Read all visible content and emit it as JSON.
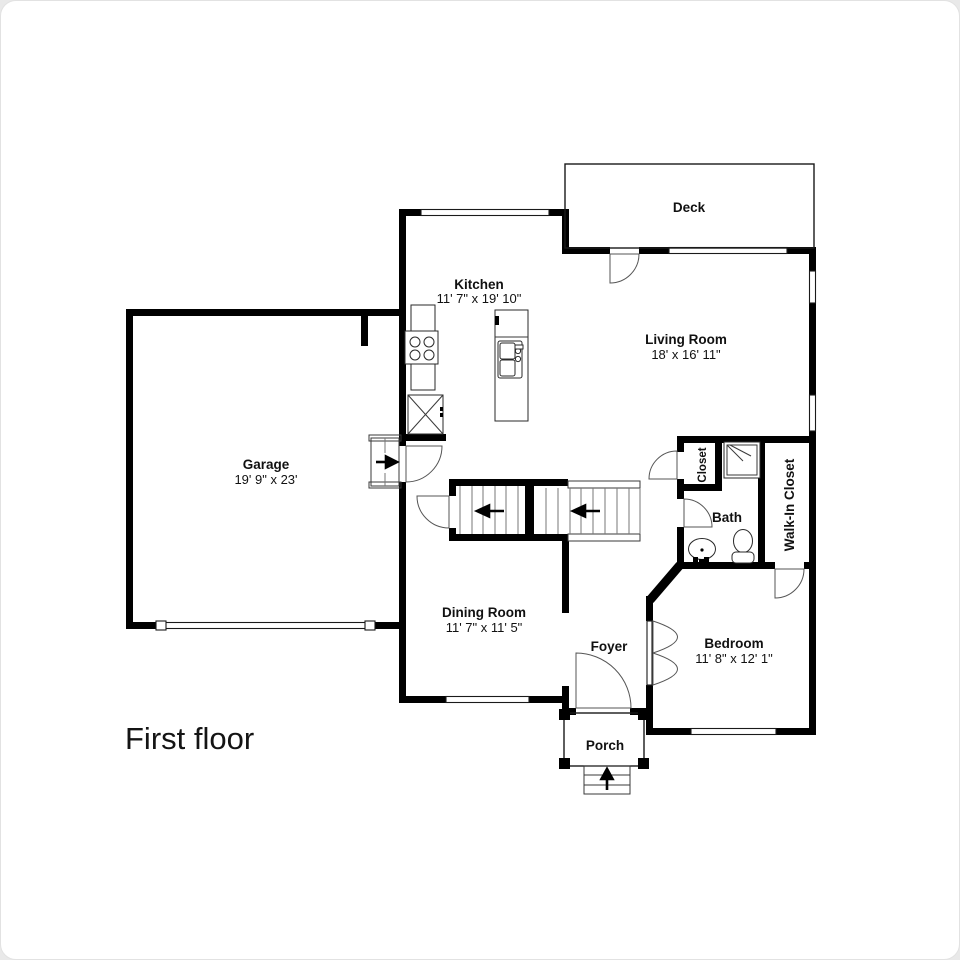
{
  "page": {
    "title": "First floor"
  },
  "plan": {
    "rooms": [
      {
        "id": "deck",
        "label": "Deck",
        "dims": ""
      },
      {
        "id": "kitchen",
        "label": "Kitchen",
        "dims": "11' 7\" x 19' 10\""
      },
      {
        "id": "living-room",
        "label": "Living Room",
        "dims": "18' x 16' 11\""
      },
      {
        "id": "garage",
        "label": "Garage",
        "dims": "19' 9\" x 23'"
      },
      {
        "id": "dining-room",
        "label": "Dining Room",
        "dims": "11' 7\" x 11' 5\""
      },
      {
        "id": "foyer",
        "label": "Foyer",
        "dims": ""
      },
      {
        "id": "porch",
        "label": "Porch",
        "dims": ""
      },
      {
        "id": "bedroom",
        "label": "Bedroom",
        "dims": "11' 8\" x 12' 1\""
      },
      {
        "id": "bath",
        "label": "Bath",
        "dims": ""
      },
      {
        "id": "closet",
        "label": "Closet",
        "dims": ""
      },
      {
        "id": "walk-in-closet",
        "label": "Walk-In Closet",
        "dims": ""
      }
    ],
    "colors": {
      "wall": "#000000",
      "background": "#ffffff",
      "text": "#111111"
    }
  }
}
